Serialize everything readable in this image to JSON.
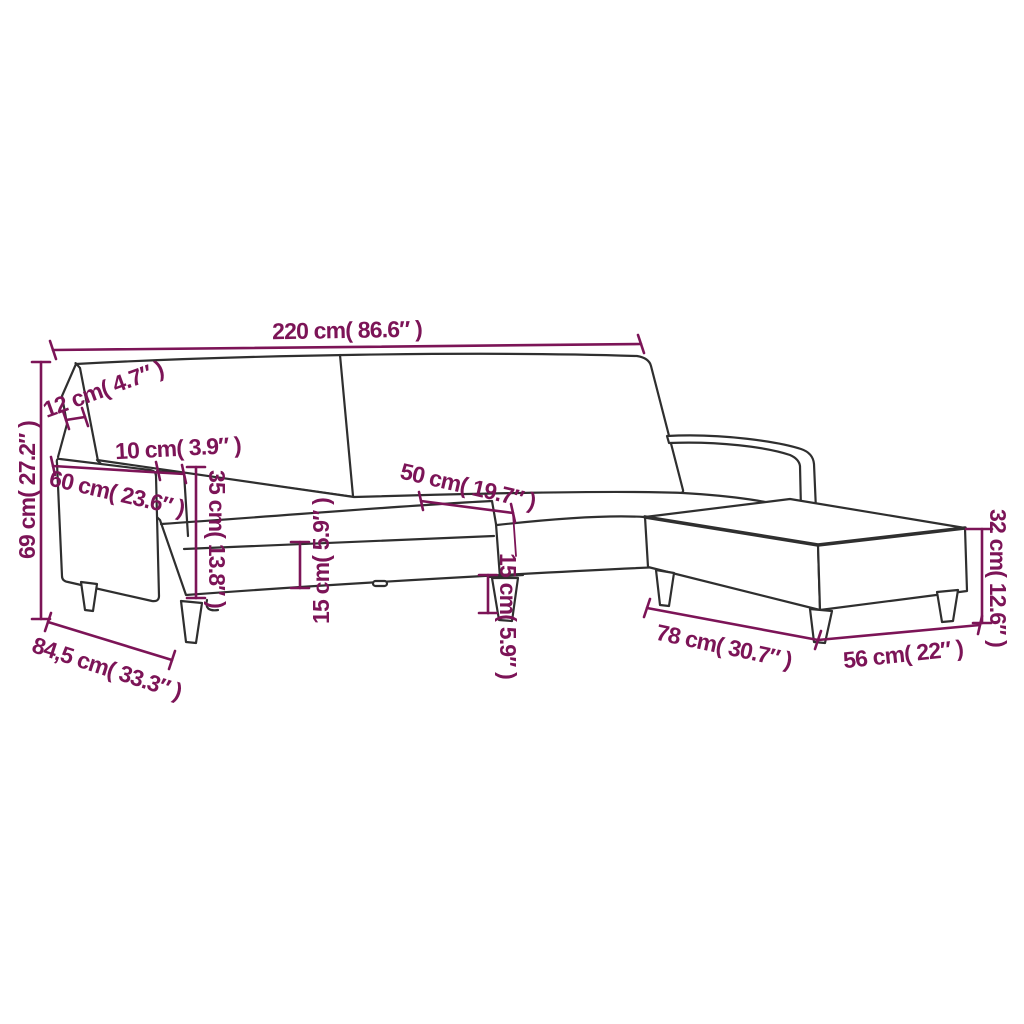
{
  "diagram": {
    "subject": "sofa-bed-with-footstool-dimension-drawing",
    "background_color": "#FFFFFF",
    "line_color": "#2F2F2F",
    "accent_color": "#7C1457",
    "dimensions": [
      {
        "name": "overall-width",
        "label": "220 cm( 86.6″ )",
        "value_cm": "220",
        "value_in": "86.6"
      },
      {
        "name": "backrest-thickness",
        "label": "12 cm( 4.7″ )",
        "value_cm": "12",
        "value_in": "4.7"
      },
      {
        "name": "armrest-width",
        "label": "10 cm( 3.9″ )",
        "value_cm": "10",
        "value_in": "3.9"
      },
      {
        "name": "armrest-length",
        "label": "60 cm( 23.6″ )",
        "value_cm": "60",
        "value_in": "23.6"
      },
      {
        "name": "seat-section-depth",
        "label": "50 cm( 19.7″ )",
        "value_cm": "50",
        "value_in": "19.7"
      },
      {
        "name": "armrest-height",
        "label": "35 cm( 13.8″ )",
        "value_cm": "35",
        "value_in": "13.8"
      },
      {
        "name": "frame-height-left",
        "label": "15 cm( 5.9″ )",
        "value_cm": "15",
        "value_in": "5.9"
      },
      {
        "name": "frame-height-right",
        "label": "15 cm( 5.9″ )",
        "value_cm": "15",
        "value_in": "5.9"
      },
      {
        "name": "overall-height",
        "label": "69 cm( 27.2″ )",
        "value_cm": "69",
        "value_in": "27.2"
      },
      {
        "name": "overall-depth",
        "label": "84,5 cm( 33.3″ )",
        "value_cm": "84,5",
        "value_in": "33.3"
      },
      {
        "name": "footstool-length",
        "label": "78 cm( 30.7″ )",
        "value_cm": "78",
        "value_in": "30.7"
      },
      {
        "name": "footstool-width",
        "label": "56 cm( 22″ )",
        "value_cm": "56",
        "value_in": "22"
      },
      {
        "name": "footstool-height",
        "label": "32 cm( 12.6″ )",
        "value_cm": "32",
        "value_in": "12.6"
      }
    ]
  }
}
